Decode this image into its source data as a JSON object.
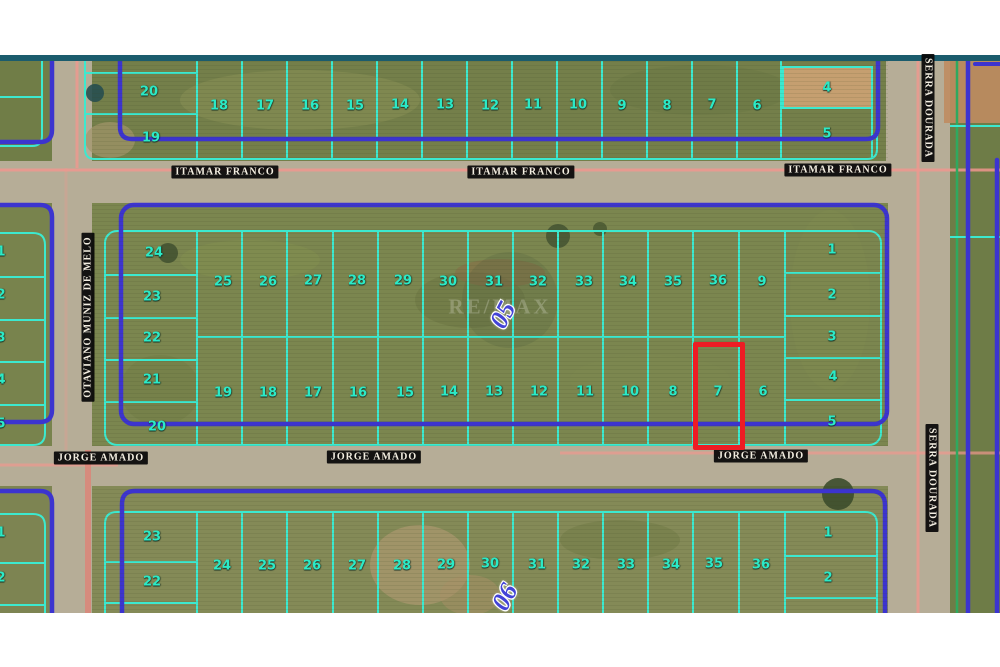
{
  "page": {
    "background": "#ffffff",
    "top_bar_color": "#1b5c6d"
  },
  "map": {
    "colors": {
      "lot_line": "#3ce9cf",
      "lot_number": "#2beac7",
      "block_border": "#3c34cf",
      "highlight": "#ed1c24",
      "survey_line_pink": "#f0978e",
      "street_label_bg": "#080808",
      "street_label_text": "#f3eee1",
      "block_number_blue": "#4343d6"
    },
    "streets": [
      {
        "name": "ITAMAR FRANCO",
        "x": 225,
        "y": 172,
        "rotation": 0
      },
      {
        "name": "ITAMAR FRANCO",
        "x": 521,
        "y": 172,
        "rotation": 0
      },
      {
        "name": "ITAMAR FRANCO",
        "x": 838,
        "y": 170,
        "rotation": 0
      },
      {
        "name": "JORGE AMADO",
        "x": 101,
        "y": 458,
        "rotation": 0
      },
      {
        "name": "JORGE AMADO",
        "x": 374,
        "y": 457,
        "rotation": 0
      },
      {
        "name": "JORGE AMADO",
        "x": 761,
        "y": 456,
        "rotation": 0
      },
      {
        "name": "OTAVIANO MUNIZ DE MELO",
        "x": 88,
        "y": 317,
        "rotation": -90
      },
      {
        "name": "SERRA DOURADA",
        "x": 928,
        "y": 108,
        "rotation": 90
      },
      {
        "name": "SERRA DOURADA",
        "x": 932,
        "y": 478,
        "rotation": 90
      }
    ],
    "block_labels": [
      {
        "text": "05",
        "x": 503,
        "y": 315
      },
      {
        "text": "06",
        "x": 505,
        "y": 597
      }
    ],
    "lot_numbers": [
      {
        "n": "20",
        "x": 149,
        "y": 92,
        "block": "top"
      },
      {
        "n": "19",
        "x": 151,
        "y": 138,
        "block": "top"
      },
      {
        "n": "18",
        "x": 219,
        "y": 106,
        "block": "top"
      },
      {
        "n": "17",
        "x": 265,
        "y": 106,
        "block": "top"
      },
      {
        "n": "16",
        "x": 310,
        "y": 106,
        "block": "top"
      },
      {
        "n": "15",
        "x": 355,
        "y": 106,
        "block": "top"
      },
      {
        "n": "14",
        "x": 400,
        "y": 105,
        "block": "top"
      },
      {
        "n": "13",
        "x": 445,
        "y": 105,
        "block": "top"
      },
      {
        "n": "12",
        "x": 490,
        "y": 106,
        "block": "top"
      },
      {
        "n": "11",
        "x": 533,
        "y": 105,
        "block": "top"
      },
      {
        "n": "10",
        "x": 578,
        "y": 105,
        "block": "top"
      },
      {
        "n": "9",
        "x": 622,
        "y": 106,
        "block": "top"
      },
      {
        "n": "8",
        "x": 667,
        "y": 106,
        "block": "top"
      },
      {
        "n": "7",
        "x": 712,
        "y": 105,
        "block": "top"
      },
      {
        "n": "6",
        "x": 757,
        "y": 106,
        "block": "top"
      },
      {
        "n": "4",
        "x": 827,
        "y": 88,
        "block": "top"
      },
      {
        "n": "5",
        "x": 827,
        "y": 134,
        "block": "top"
      },
      {
        "n": "24",
        "x": 154,
        "y": 253,
        "block": "middle"
      },
      {
        "n": "23",
        "x": 152,
        "y": 297,
        "block": "middle"
      },
      {
        "n": "22",
        "x": 152,
        "y": 338,
        "block": "middle"
      },
      {
        "n": "21",
        "x": 152,
        "y": 380,
        "block": "middle"
      },
      {
        "n": "20",
        "x": 157,
        "y": 427,
        "block": "middle"
      },
      {
        "n": "25",
        "x": 223,
        "y": 282,
        "block": "middle"
      },
      {
        "n": "26",
        "x": 268,
        "y": 282,
        "block": "middle"
      },
      {
        "n": "27",
        "x": 313,
        "y": 281,
        "block": "middle"
      },
      {
        "n": "28",
        "x": 357,
        "y": 281,
        "block": "middle"
      },
      {
        "n": "29",
        "x": 403,
        "y": 281,
        "block": "middle"
      },
      {
        "n": "30",
        "x": 448,
        "y": 282,
        "block": "middle"
      },
      {
        "n": "31",
        "x": 494,
        "y": 282,
        "block": "middle"
      },
      {
        "n": "32",
        "x": 538,
        "y": 282,
        "block": "middle"
      },
      {
        "n": "33",
        "x": 584,
        "y": 282,
        "block": "middle"
      },
      {
        "n": "34",
        "x": 628,
        "y": 282,
        "block": "middle"
      },
      {
        "n": "35",
        "x": 673,
        "y": 282,
        "block": "middle"
      },
      {
        "n": "36",
        "x": 718,
        "y": 281,
        "block": "middle"
      },
      {
        "n": "9",
        "x": 762,
        "y": 282,
        "block": "middle"
      },
      {
        "n": "1",
        "x": 832,
        "y": 250,
        "block": "middle"
      },
      {
        "n": "2",
        "x": 832,
        "y": 295,
        "block": "middle"
      },
      {
        "n": "3",
        "x": 832,
        "y": 337,
        "block": "middle"
      },
      {
        "n": "4",
        "x": 833,
        "y": 377,
        "block": "middle"
      },
      {
        "n": "5",
        "x": 832,
        "y": 422,
        "block": "middle"
      },
      {
        "n": "19",
        "x": 223,
        "y": 393,
        "block": "middle"
      },
      {
        "n": "18",
        "x": 268,
        "y": 393,
        "block": "middle"
      },
      {
        "n": "17",
        "x": 313,
        "y": 393,
        "block": "middle"
      },
      {
        "n": "16",
        "x": 358,
        "y": 393,
        "block": "middle"
      },
      {
        "n": "15",
        "x": 405,
        "y": 393,
        "block": "middle"
      },
      {
        "n": "14",
        "x": 449,
        "y": 392,
        "block": "middle"
      },
      {
        "n": "13",
        "x": 494,
        "y": 392,
        "block": "middle"
      },
      {
        "n": "12",
        "x": 539,
        "y": 392,
        "block": "middle"
      },
      {
        "n": "11",
        "x": 585,
        "y": 392,
        "block": "middle"
      },
      {
        "n": "10",
        "x": 630,
        "y": 392,
        "block": "middle"
      },
      {
        "n": "8",
        "x": 673,
        "y": 392,
        "block": "middle"
      },
      {
        "n": "7",
        "x": 718,
        "y": 392,
        "block": "middle"
      },
      {
        "n": "6",
        "x": 763,
        "y": 392,
        "block": "middle"
      },
      {
        "n": "23",
        "x": 152,
        "y": 537,
        "block": "bottom"
      },
      {
        "n": "22",
        "x": 152,
        "y": 582,
        "block": "bottom"
      },
      {
        "n": "24",
        "x": 222,
        "y": 566,
        "block": "bottom"
      },
      {
        "n": "25",
        "x": 267,
        "y": 566,
        "block": "bottom"
      },
      {
        "n": "26",
        "x": 312,
        "y": 566,
        "block": "bottom"
      },
      {
        "n": "27",
        "x": 357,
        "y": 566,
        "block": "bottom"
      },
      {
        "n": "28",
        "x": 402,
        "y": 566,
        "block": "bottom"
      },
      {
        "n": "29",
        "x": 446,
        "y": 565,
        "block": "bottom"
      },
      {
        "n": "30",
        "x": 490,
        "y": 564,
        "block": "bottom"
      },
      {
        "n": "31",
        "x": 537,
        "y": 565,
        "block": "bottom"
      },
      {
        "n": "32",
        "x": 581,
        "y": 565,
        "block": "bottom"
      },
      {
        "n": "33",
        "x": 626,
        "y": 565,
        "block": "bottom"
      },
      {
        "n": "34",
        "x": 671,
        "y": 565,
        "block": "bottom"
      },
      {
        "n": "35",
        "x": 714,
        "y": 564,
        "block": "bottom"
      },
      {
        "n": "36",
        "x": 761,
        "y": 565,
        "block": "bottom"
      },
      {
        "n": "1",
        "x": 828,
        "y": 533,
        "block": "bottom"
      },
      {
        "n": "2",
        "x": 828,
        "y": 578,
        "block": "bottom"
      },
      {
        "n": "1",
        "x": 1,
        "y": 252,
        "block": "left-edge"
      },
      {
        "n": "2",
        "x": 1,
        "y": 295,
        "block": "left-edge"
      },
      {
        "n": "3",
        "x": 1,
        "y": 338,
        "block": "left-edge"
      },
      {
        "n": "4",
        "x": 1,
        "y": 380,
        "block": "left-edge"
      },
      {
        "n": "5",
        "x": 1,
        "y": 424,
        "block": "left-edge"
      },
      {
        "n": "1",
        "x": 1,
        "y": 533,
        "block": "left-edge"
      },
      {
        "n": "2",
        "x": 1,
        "y": 578,
        "block": "left-edge"
      }
    ],
    "highlight": {
      "lot": "7",
      "x": 693,
      "y": 342,
      "w": 52,
      "h": 108,
      "color": "#ed1c24"
    },
    "watermark": {
      "text": "RE/MAX"
    }
  }
}
